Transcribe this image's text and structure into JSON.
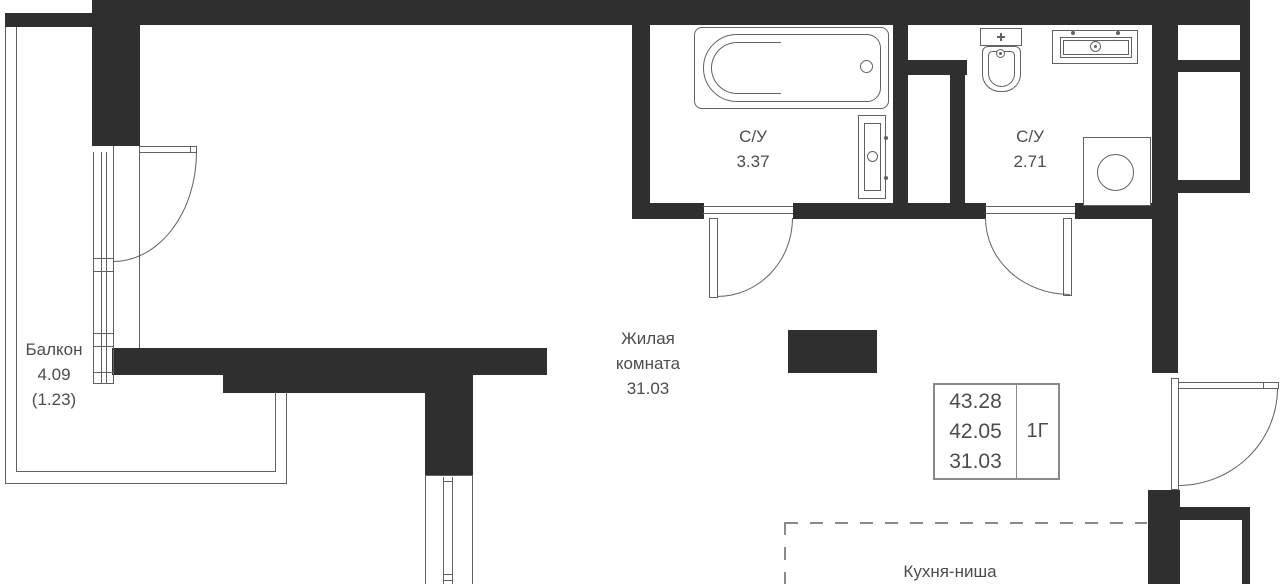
{
  "plan": {
    "type": "apartment-floor-plan",
    "unit_label": "1Г",
    "summary": {
      "total_area": "43.28",
      "reduced_area": "42.05",
      "living_area": "31.03"
    },
    "rooms": [
      {
        "id": "balcony",
        "name": "Балкон",
        "area": "4.09",
        "area_note": "(1.23)"
      },
      {
        "id": "bathroom-1",
        "name": "С/У",
        "area": "3.37"
      },
      {
        "id": "bathroom-2",
        "name": "С/У",
        "area": "2.71"
      },
      {
        "id": "living-room",
        "name": "Жилая комната",
        "area": "31.03"
      },
      {
        "id": "kitchen-niche",
        "name": "Кухня-ниша"
      }
    ],
    "fixtures": [
      "bathtub",
      "towel-rail",
      "toilet",
      "sink",
      "washing-machine"
    ],
    "colors": {
      "wall": "#2f2f2f",
      "line": "#616161",
      "text": "#4d4d4d",
      "background": "#ffffff"
    }
  }
}
